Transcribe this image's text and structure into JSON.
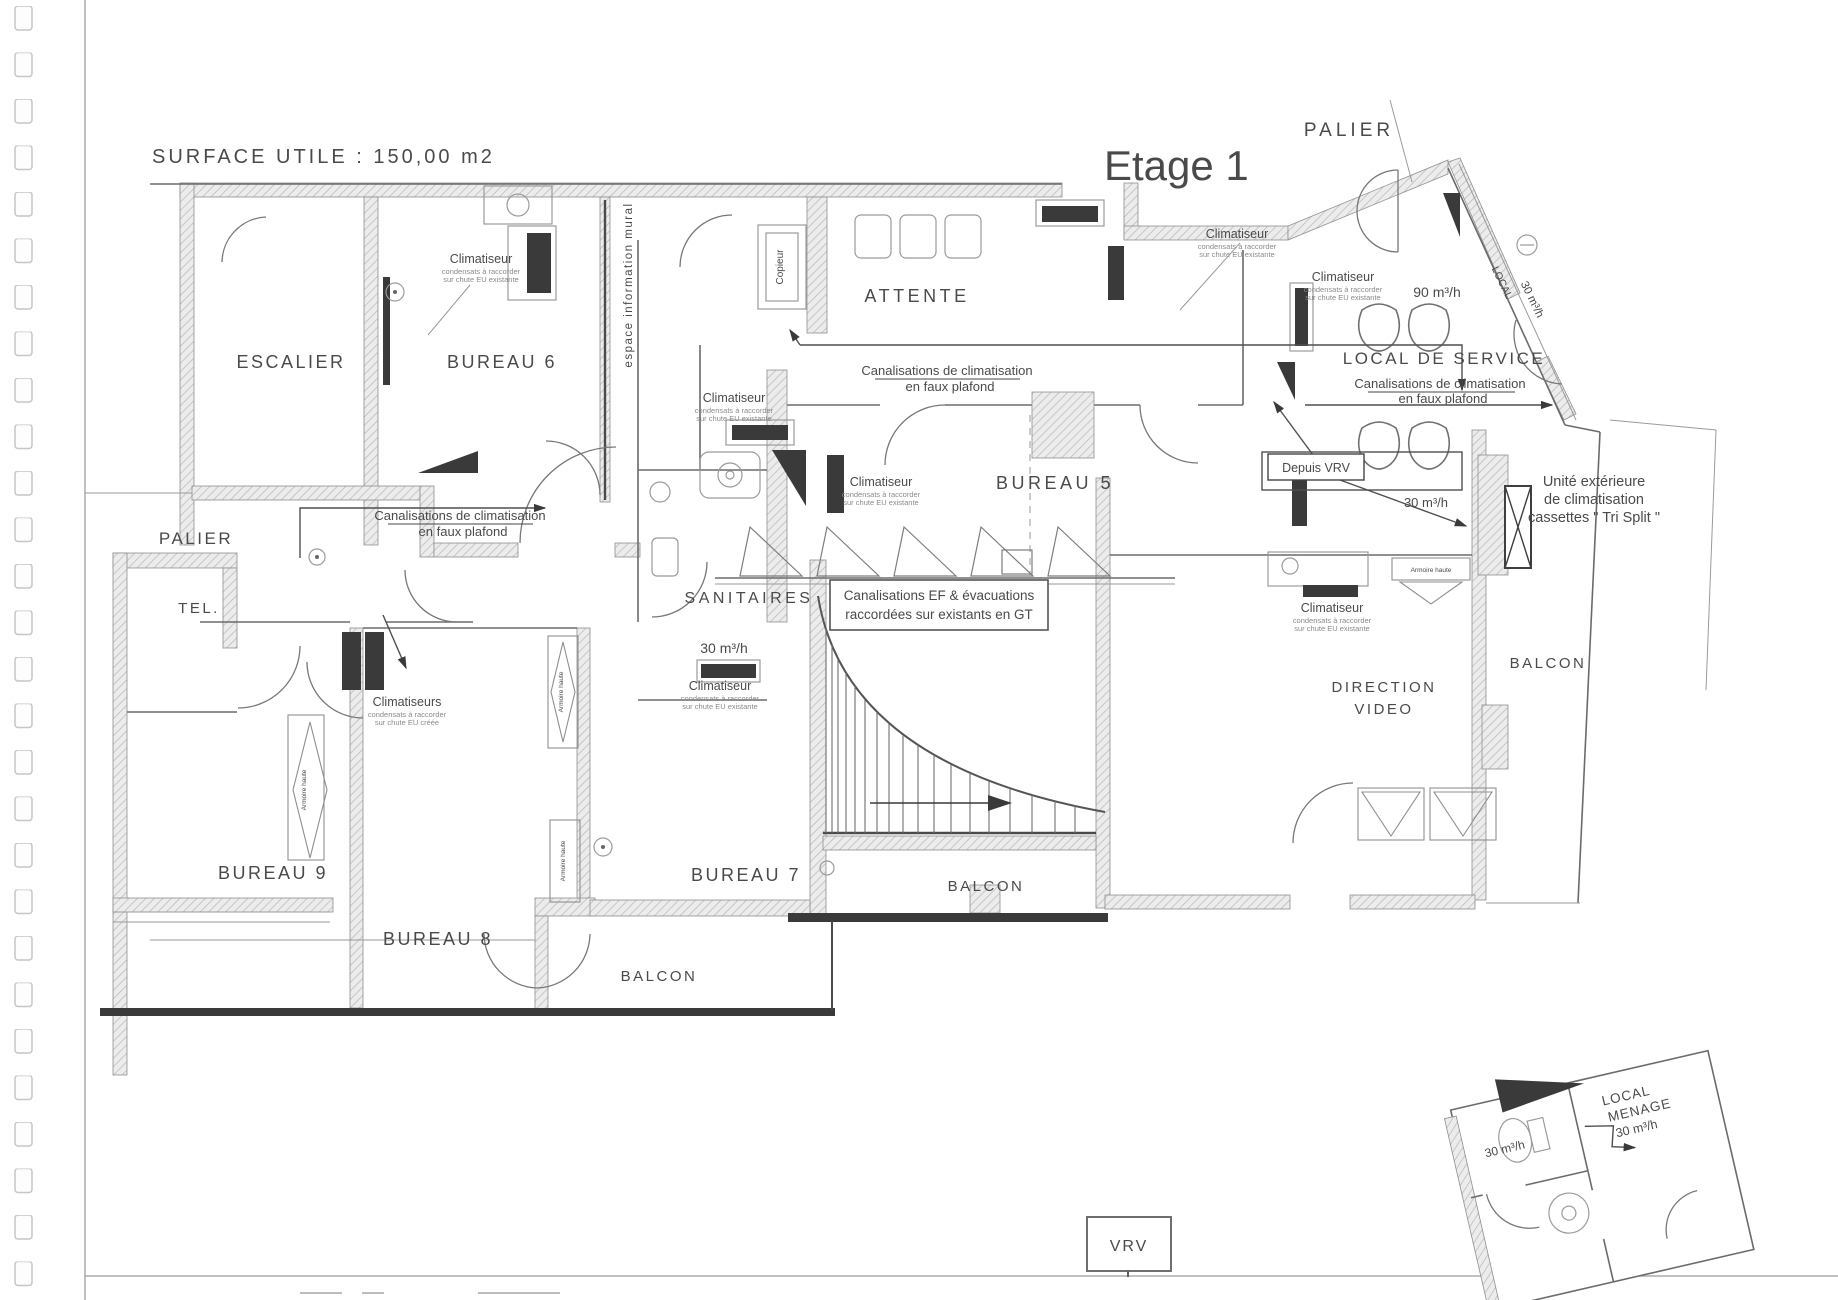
{
  "page": {
    "surface_title": "SURFACE UTILE : 150,00 m2",
    "floor_title": "Etage 1"
  },
  "rooms": {
    "palier_top": "PALIER",
    "escalier": "ESCALIER",
    "bureau6": "BUREAU 6",
    "attente": "ATTENTE",
    "local_de_service": "LOCAL DE SERVICE",
    "bureau5": "BUREAU 5",
    "palier_left": "PALIER",
    "tel": "TEL.",
    "sanitaires": "SANITAIRES",
    "direction_l1": "DIRECTION",
    "direction_l2": "VIDEO",
    "balcon_right": "BALCON",
    "bureau9": "BUREAU 9",
    "bureau8": "BUREAU 8",
    "bureau7": "BUREAU 7",
    "balcon_left": "BALCON",
    "balcon_center": "BALCON"
  },
  "airflow": {
    "local_service": "90 m³/h",
    "sanitaires": "30 m³/h",
    "depuis_vrv_zone": "30 m³/h",
    "local_vent_label": "LOCAL",
    "local_vent_flow": "30 m³/h",
    "inset_left": "30 m³/h"
  },
  "ac": {
    "title": "Climatiseur",
    "title_plural": "Climatiseurs",
    "line1": "condensats à raccorder",
    "line2": "sur chute EU existante",
    "line2_alt": "sur chute EU créée"
  },
  "canalisations": {
    "clim_l1": "Canalisations de climatisation",
    "clim_l2": "en faux plafond",
    "ef_l1": "Canalisations EF & évacuations",
    "ef_l2": "raccordées sur existants en GT"
  },
  "misc": {
    "depuis_vrv": "Depuis VRV",
    "unite_l1": "Unité extérieure",
    "unite_l2": "de climatisation",
    "unite_l3": "cassettes \" Tri Split \"",
    "espace_mural": "espace information mural",
    "copieur": "Copieur",
    "vrv": "VRV",
    "armoire": "Armoire haute",
    "inset_l1": "LOCAL",
    "inset_l2": "MENAGE",
    "inset_l3": "30 m³/h"
  }
}
